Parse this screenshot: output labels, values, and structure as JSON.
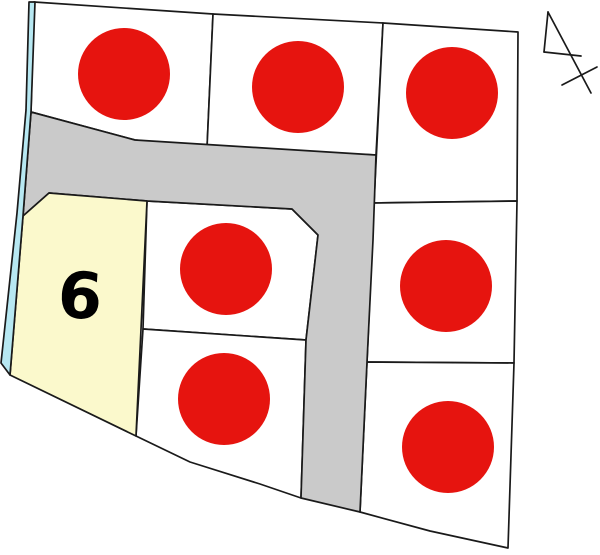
{
  "map": {
    "sold_stamp_label": "済",
    "available_lot_number": "6",
    "sold_stamps": [
      {
        "parcel": "top-left"
      },
      {
        "parcel": "top-center"
      },
      {
        "parcel": "right-top"
      },
      {
        "parcel": "center"
      },
      {
        "parcel": "right-middle"
      },
      {
        "parcel": "center-bottom"
      },
      {
        "parcel": "right-bottom"
      }
    ]
  },
  "colors": {
    "stamp_red": "#e6140f",
    "stamp_text_white": "#ffffff",
    "available_lot_yellow": "#fbf9cc",
    "road_gray": "#cacaca",
    "waterway_cyan": "#b7e8f2",
    "line_black": "#1a1a1a",
    "lot_number_black": "#000000",
    "parcel_white": "#ffffff",
    "background_white": "#ffffff"
  }
}
